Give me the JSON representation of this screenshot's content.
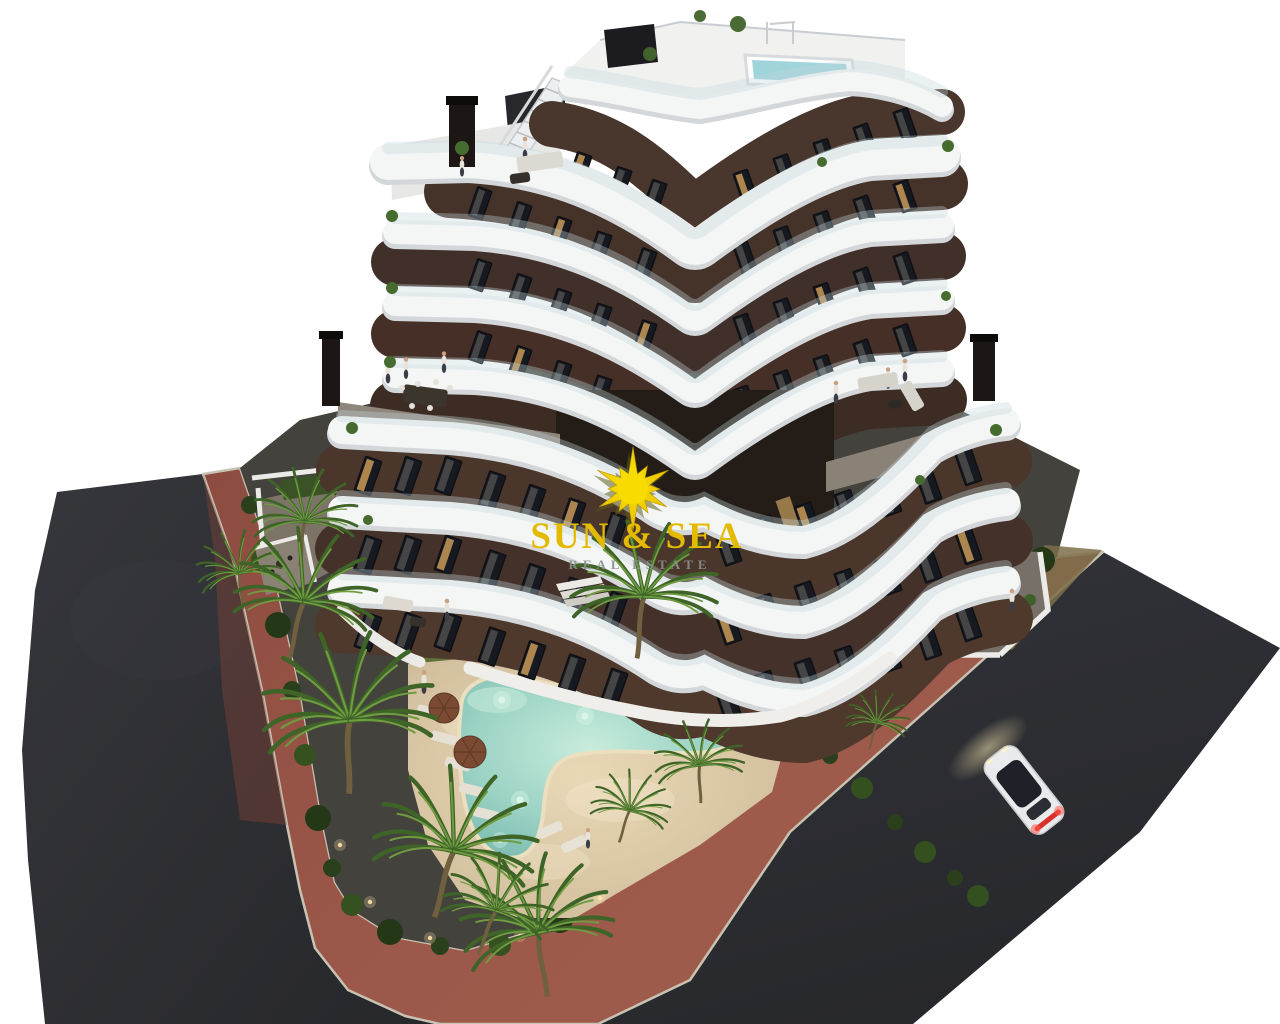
{
  "watermark": {
    "title": "SUN & SEA",
    "subtitle": "REAL ESTATE",
    "logo": "sun-logo"
  },
  "scene": {
    "type": "3d-architectural-render",
    "subject": "modern-apartment-residence-with-garden-and-pool",
    "objects": [
      "apartment-building",
      "rooftop-pool",
      "rooftop-terraces",
      "balconies",
      "white-balcony-bands",
      "swimming-pool",
      "pool-deck",
      "sun-loungers",
      "parasols",
      "lawn",
      "island-planter",
      "palm-trees",
      "hedges",
      "paved-sidewalk",
      "asphalt-street",
      "white-car",
      "pedestrians",
      "watermark-logo"
    ],
    "colors": {
      "sky": "#ffffff",
      "asphalt": "#2b2c30",
      "sidewalk_red": "#99574a",
      "curb": "#c8c2b2",
      "facade_brown": "#47352b",
      "band_white": "#f4f5f5",
      "window_glass": "#161920",
      "lit_window": "#c89a58",
      "lawn_green": "#65743c",
      "hedge_green": "#2a401d",
      "palm_green": "#4a7030",
      "pool_water": "#8fcec2",
      "pool_deck_sand": "#d9c7a6",
      "rooftop_pool": "#9fd4da",
      "car_body": "#e9eaec",
      "taillight_red": "#e03427",
      "sun_gold": "#e3ba00",
      "subtitle_gray": "#8b908c"
    }
  }
}
